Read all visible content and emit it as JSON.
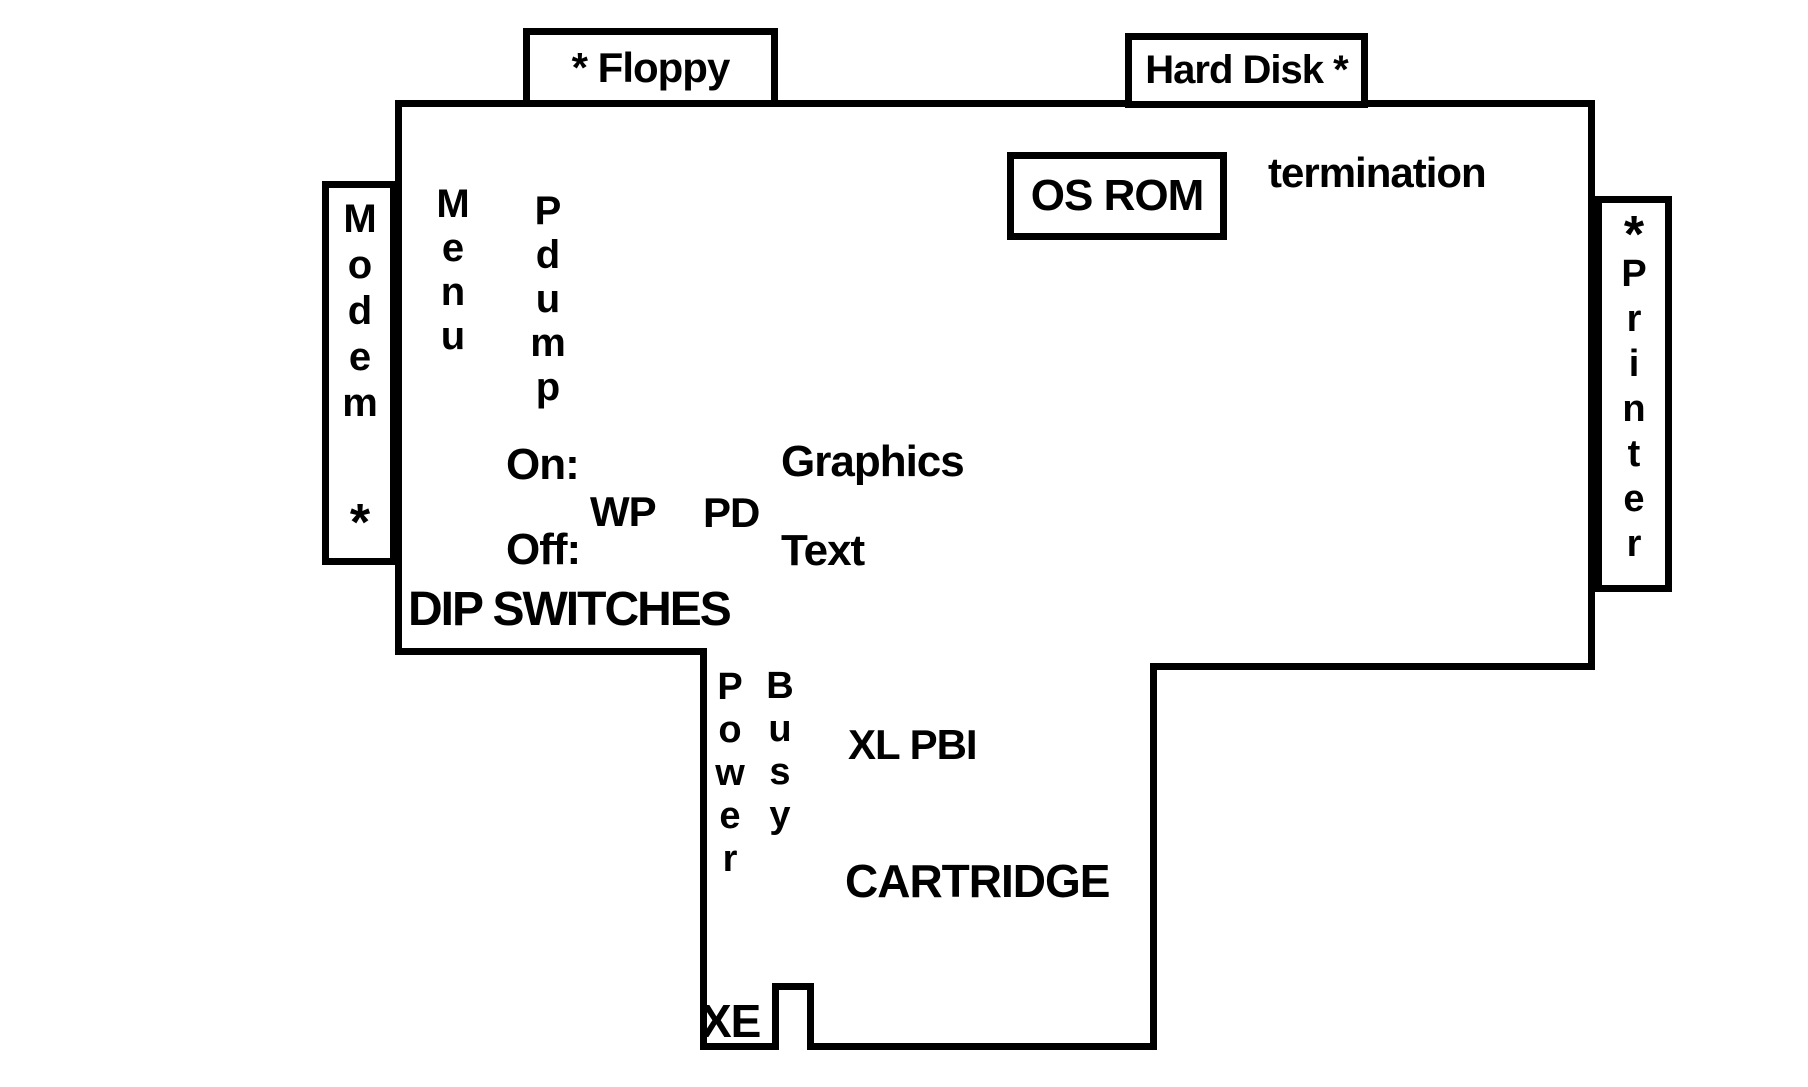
{
  "colors": {
    "ink": "#000000",
    "paper": "#ffffff"
  },
  "connectors": {
    "floppy": "* Floppy",
    "hard_disk": "Hard Disk *",
    "modem": {
      "word": "Modem",
      "asterisk": "*"
    },
    "printer": {
      "word": "Printer",
      "asterisk": "*"
    }
  },
  "chips": {
    "os_rom": "OS ROM",
    "termination": "termination"
  },
  "buttons": {
    "menu": "Menu",
    "pdump": "Pdump"
  },
  "dip_switches": {
    "heading": "DIP SWITCHES",
    "on_label": "On:",
    "off_label": "Off:",
    "switches": [
      "WP",
      "PD"
    ],
    "on_meaning": "Graphics",
    "off_meaning": "Text"
  },
  "leds": {
    "power": "Power",
    "busy": "Busy"
  },
  "bottom": {
    "xl_pbi": "XL PBI",
    "cartridge": "CARTRIDGE",
    "xe": "XE"
  }
}
